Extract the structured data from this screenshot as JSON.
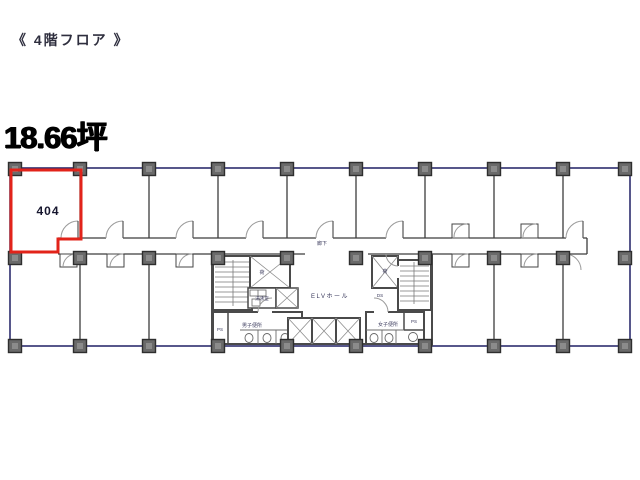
{
  "header": {
    "floor_title": "《 4階フロア 》",
    "area_size": "18.66坪"
  },
  "plan": {
    "room_number": "404",
    "corridor_label": "廊下",
    "elv_hall_label": "ELVホール",
    "mens_toilet_label": "男子便所",
    "womens_toilet_label": "女子便所",
    "kitchenette_label": "湯沸室",
    "freight_left_label": "荷",
    "freight_right_label": "荷",
    "duct_label": "DS",
    "ps_left_label": "PS",
    "ps_right_label": "PS",
    "colors": {
      "highlight_red": "#e2231a",
      "outline_navy": "#2d2d6e",
      "wall_gray": "#4a4a4a",
      "column_gray": "#6a6a6a"
    }
  }
}
